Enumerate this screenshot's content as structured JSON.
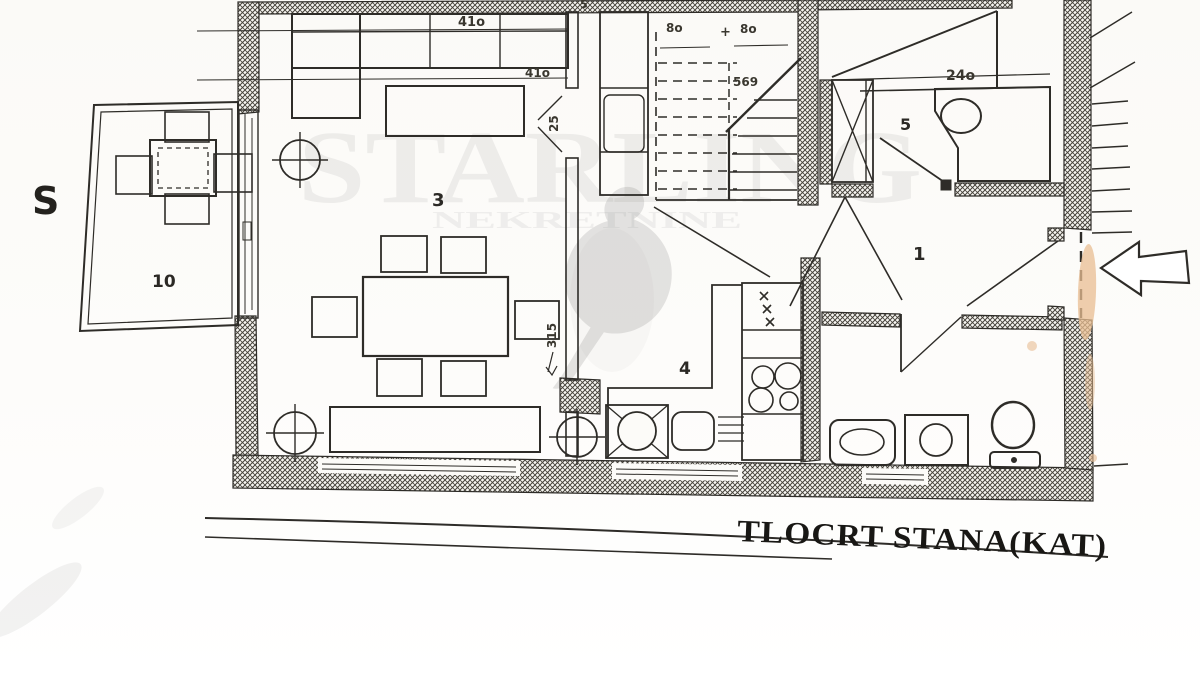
{
  "title": {
    "text": "TLOCRT STANA(KAT)"
  },
  "compass": {
    "label": "S"
  },
  "rooms": {
    "hall": "1",
    "living": "3",
    "kitchen": "4",
    "bath_upper": "5",
    "balcony": "10"
  },
  "dimensions": {
    "sofa_top": "41o",
    "sofa_inner": "41o",
    "room5_width": "24o",
    "stairs_left": "8o",
    "stairs_plus": "+",
    "stairs_right": "8o",
    "stairs_run": "569",
    "living_door": "25",
    "living_depth": "315",
    "top_edge_partial": "5"
  },
  "watermark": {
    "brand": "STARLING",
    "subtitle": "NEKRETNINE"
  },
  "entry_arrow": {
    "direction": "left"
  },
  "colors": {
    "ink": "#2e2c28",
    "paper": "#fcfbf8",
    "stain": "#e8bd92",
    "watermark_gray": "#8a8a8a"
  }
}
